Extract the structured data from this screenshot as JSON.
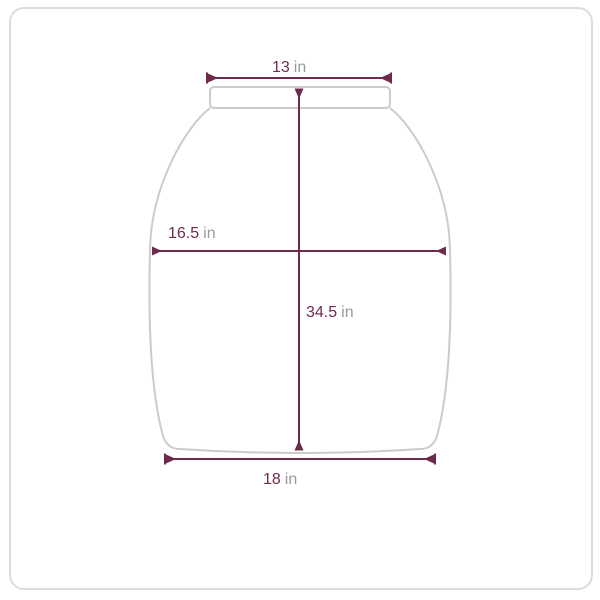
{
  "schematic": {
    "description": "garment measurement diagram",
    "measurements": {
      "top_width": {
        "value": "13",
        "unit": "in"
      },
      "mid_width": {
        "value": "16.5",
        "unit": "in"
      },
      "length": {
        "value": "34.5",
        "unit": "in"
      },
      "bottom_width": {
        "value": "18",
        "unit": "in"
      }
    }
  },
  "colors": {
    "dimension": "#6e2b4e",
    "unit_text": "#9a9a9a",
    "garment_outline": "#cbcbcb",
    "card_border": "#dcdcdc",
    "background": "#ffffff"
  }
}
